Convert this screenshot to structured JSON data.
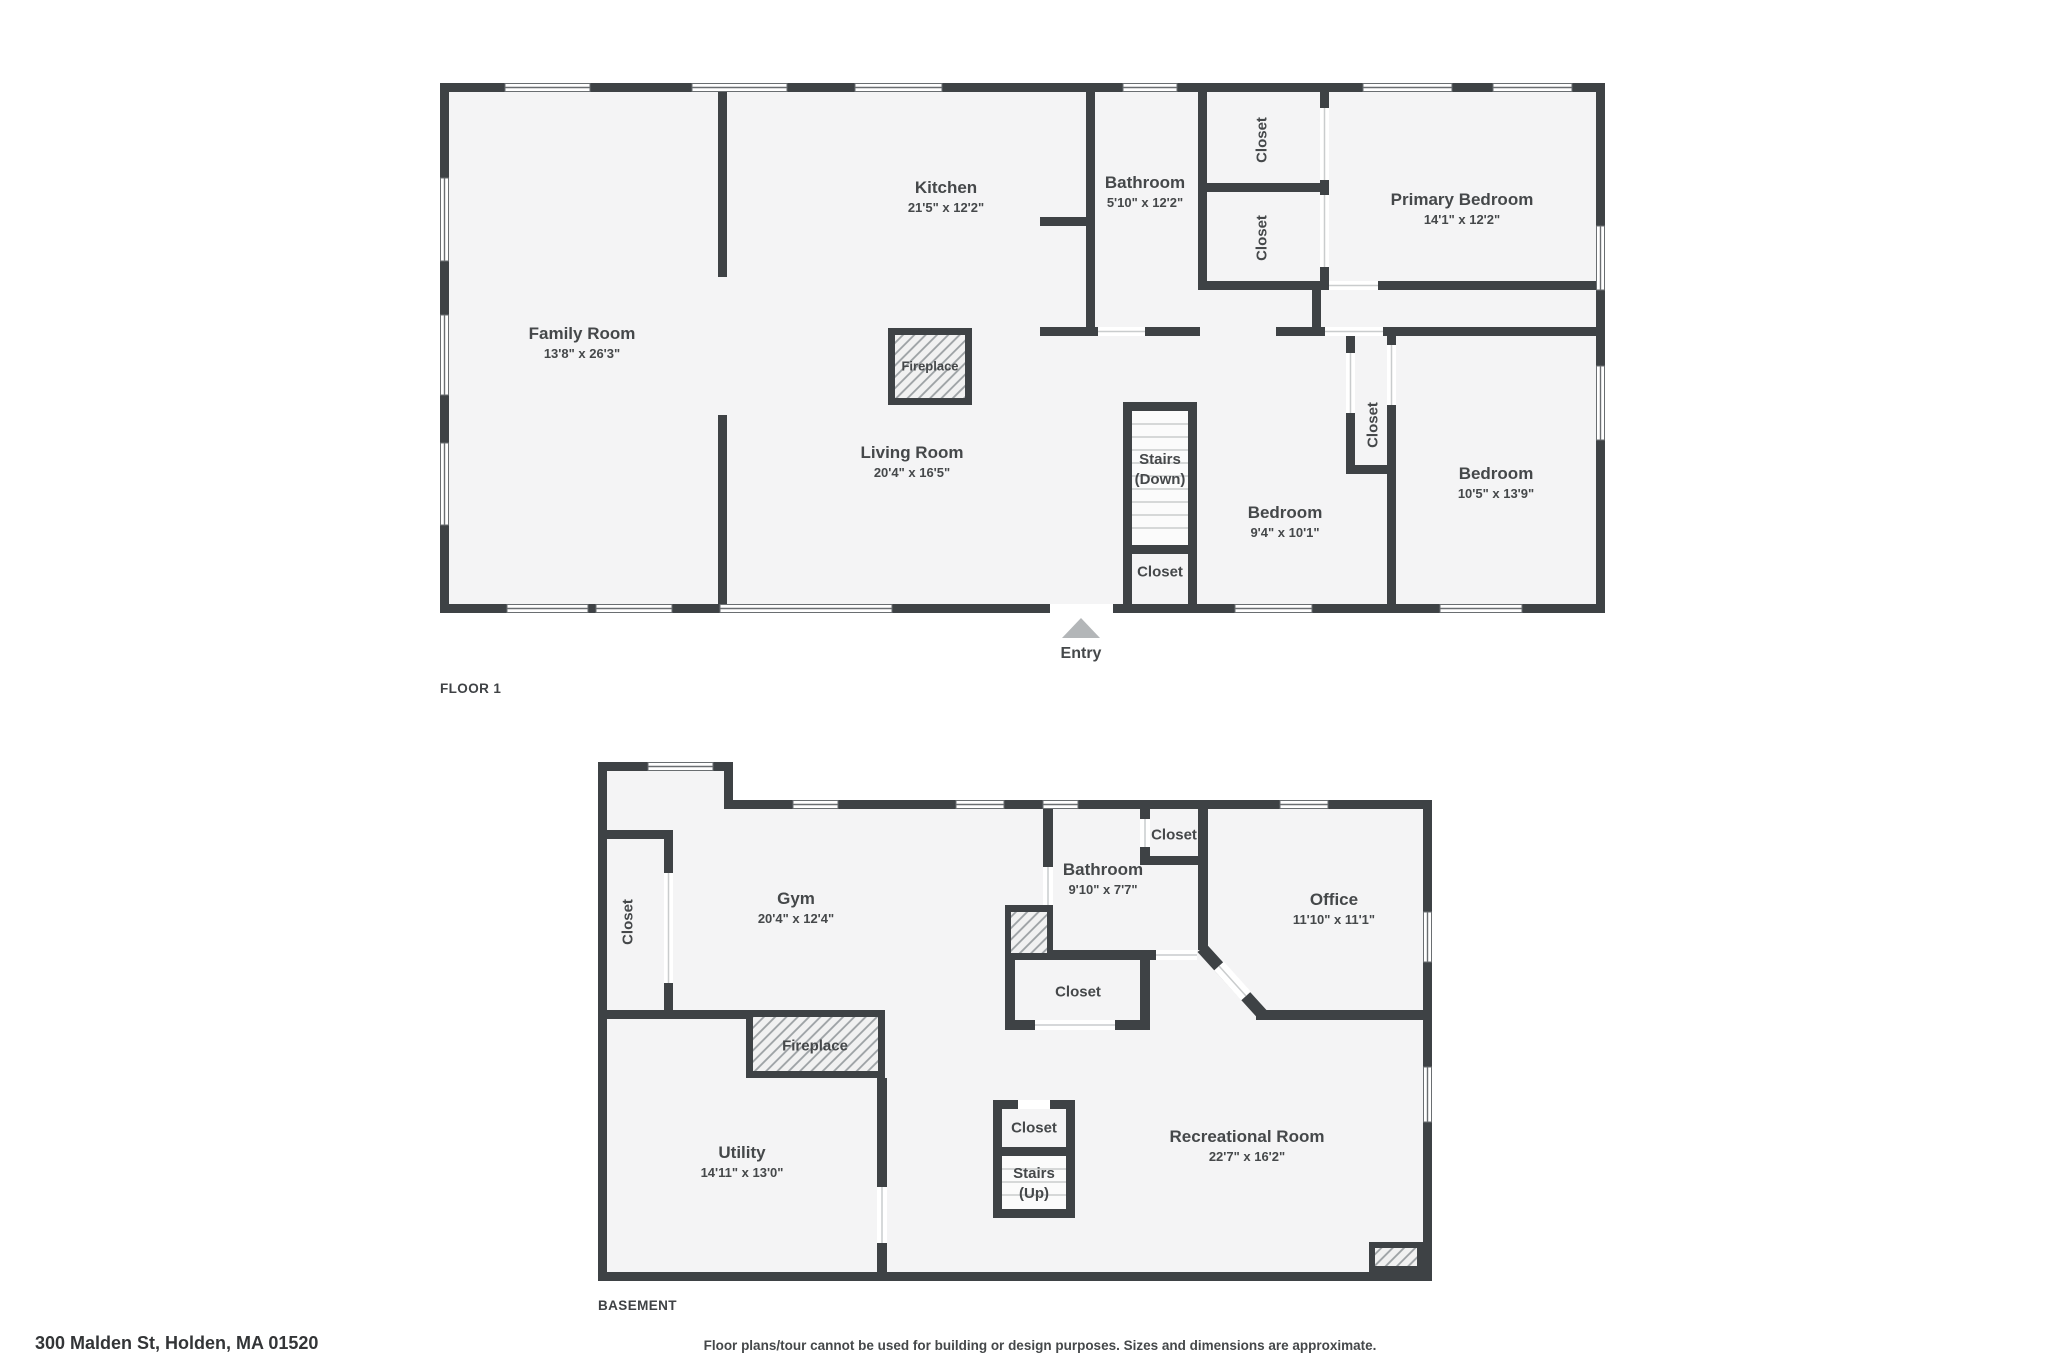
{
  "page": {
    "address": "300 Malden St, Holden, MA 01520",
    "disclaimer": "Floor plans/tour cannot be used for building or design purposes. Sizes and dimensions are approximate."
  },
  "floor1": {
    "label": "FLOOR 1",
    "entry": "Entry",
    "rooms": {
      "family": {
        "name": "Family Room",
        "dims": "13'8\" x 26'3\""
      },
      "kitchen": {
        "name": "Kitchen",
        "dims": "21'5\" x 12'2\""
      },
      "bathroom": {
        "name": "Bathroom",
        "dims": "5'10\" x 12'2\""
      },
      "closet_a": {
        "name": "Closet"
      },
      "closet_b": {
        "name": "Closet"
      },
      "primary": {
        "name": "Primary Bedroom",
        "dims": "14'1\" x 12'2\""
      },
      "living": {
        "name": "Living Room",
        "dims": "20'4\" x 16'5\""
      },
      "fireplace": {
        "name": "Fireplace"
      },
      "stairs": {
        "name": "Stairs",
        "sub": "(Down)"
      },
      "stairs_closet": {
        "name": "Closet"
      },
      "bedroom_small": {
        "name": "Bedroom",
        "dims": "9'4\" x 10'1\""
      },
      "bedroom_closet": {
        "name": "Closet"
      },
      "bedroom": {
        "name": "Bedroom",
        "dims": "10'5\" x 13'9\""
      }
    }
  },
  "basement": {
    "label": "BASEMENT",
    "rooms": {
      "gym": {
        "name": "Gym",
        "dims": "20'4\" x 12'4\""
      },
      "gym_closet": {
        "name": "Closet"
      },
      "bathroom": {
        "name": "Bathroom",
        "dims": "9'10\" x 7'7\""
      },
      "office_closet": {
        "name": "Closet"
      },
      "office": {
        "name": "Office",
        "dims": "11'10\" x 11'1\""
      },
      "hall_closet": {
        "name": "Closet"
      },
      "fireplace": {
        "name": "Fireplace"
      },
      "utility": {
        "name": "Utility",
        "dims": "14'11\" x 13'0\""
      },
      "stairs_closet": {
        "name": "Closet"
      },
      "stairs": {
        "name": "Stairs",
        "sub": "(Up)"
      },
      "rec": {
        "name": "Recreational Room",
        "dims": "22'7\" x 16'2\""
      }
    }
  }
}
